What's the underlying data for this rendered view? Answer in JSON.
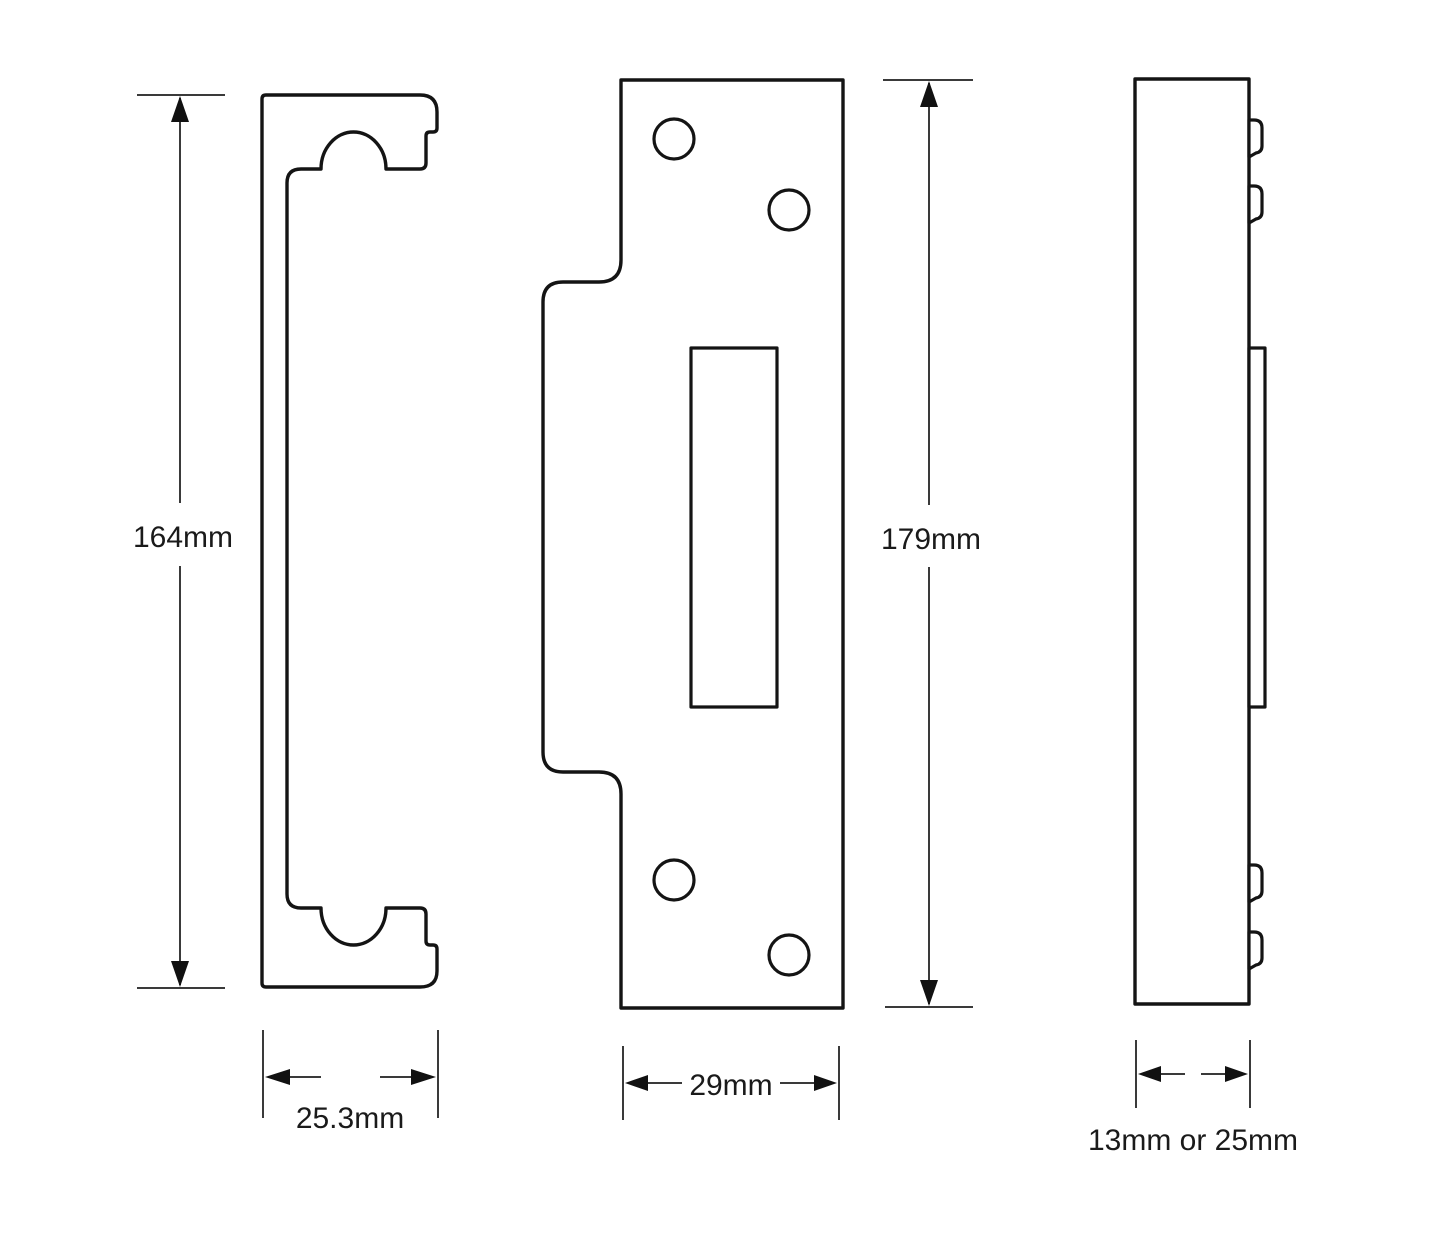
{
  "diagram": {
    "dimensions": {
      "left_height": "164mm",
      "left_width": "25.3mm",
      "front_height": "179mm",
      "front_width": "29mm",
      "side_thickness": "13mm or 25mm"
    },
    "colors": {
      "background": "#ffffff",
      "outline": "#141414",
      "dimension_lines": "#3a3a3a",
      "text": "#1a1a1a"
    }
  }
}
